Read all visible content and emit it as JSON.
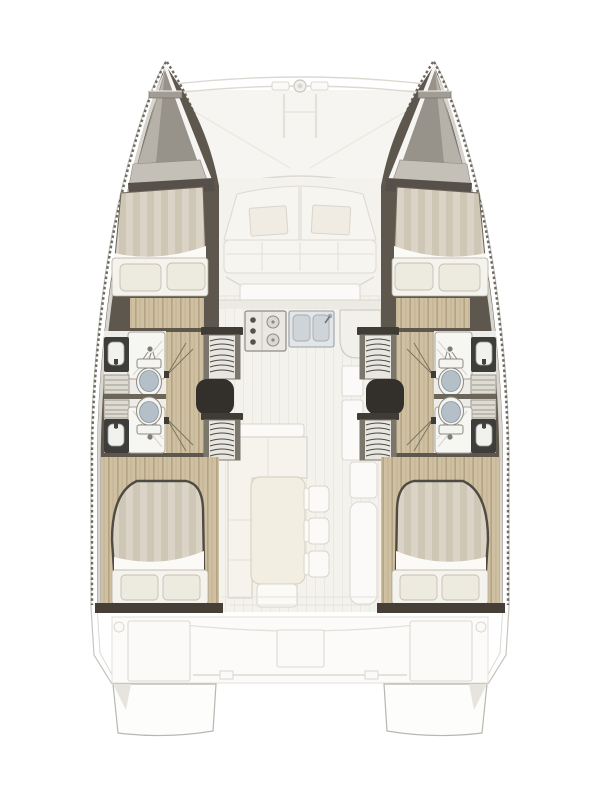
{
  "diagram": {
    "type": "catamaran-floor-plan",
    "view": "top-down",
    "hulls": 2,
    "cabins": [
      {
        "id": "forward-port",
        "bed": "double",
        "pillows": 2
      },
      {
        "id": "aft-port",
        "bed": "double",
        "pillows": 2
      },
      {
        "id": "forward-starboard",
        "bed": "double",
        "pillows": 2
      },
      {
        "id": "aft-starboard",
        "bed": "double",
        "pillows": 2
      }
    ],
    "heads": 4,
    "showers": 4,
    "toilets": 4,
    "sinks": 4,
    "companionway_stairs": 4,
    "saloon": {
      "sofa": "L-shaped",
      "tables": 1,
      "chairs": 3,
      "galley": {
        "stove_knobs": 3,
        "stove_burners": 2,
        "sink_basins": 2,
        "corner_bowl": 1
      }
    },
    "foredeck": {
      "trampoline": true,
      "seat_cushions": 2,
      "crossbeam_ring": 1
    },
    "aft_cockpit": {
      "bench_boxes": 2,
      "table": 1,
      "transom_steps": 2,
      "cleats": 2
    }
  },
  "palette": {
    "background": "#ffffff",
    "outline": "#c8c5bf",
    "fadedLine": "#dcd9d2",
    "fadedFill": "#fbfaf8",
    "hullWall": "#5e574d",
    "gunwale": "#d8d5ce",
    "hatch": "#6f6a61",
    "bowDeck": "#b7b2a9",
    "bowDeckShade": "#98938a",
    "bowPlatform": "#c5c0b7",
    "wood": "#cfc0a2",
    "woodStripe": "#b4a384",
    "duvet": "#dbd4c6",
    "duvetStripe": "#cfc7b6",
    "sheet": "#fbfaf7",
    "pillow": "#edeadf",
    "bedOutline": "#4f4a42",
    "bathFloor": "#edece8",
    "fixtureWhite": "#f4f4f1",
    "fixtureStroke": "#8f8a80",
    "toiletSeat": "#b4bfc7",
    "sinkDark": "#3f3d39",
    "stairBody": "#e8e6e1",
    "stairRail": "#7b766c",
    "stairStep": "#4e4a44",
    "doorway": "#33302b",
    "sillDark": "#453f38",
    "saloonFloor": "#f4f2ec",
    "plankLine": "#ebe8e1",
    "furnitureFill": "#f6f3ec",
    "furnitureStroke": "#d9d5cb",
    "tableFill": "#f3eee2",
    "tableStroke": "#d9d3c3",
    "steel": "#e3e6e8",
    "steelStroke": "#98a0a5",
    "applianceStroke": "#8f8a81",
    "wallMid": "#6b655a"
  }
}
